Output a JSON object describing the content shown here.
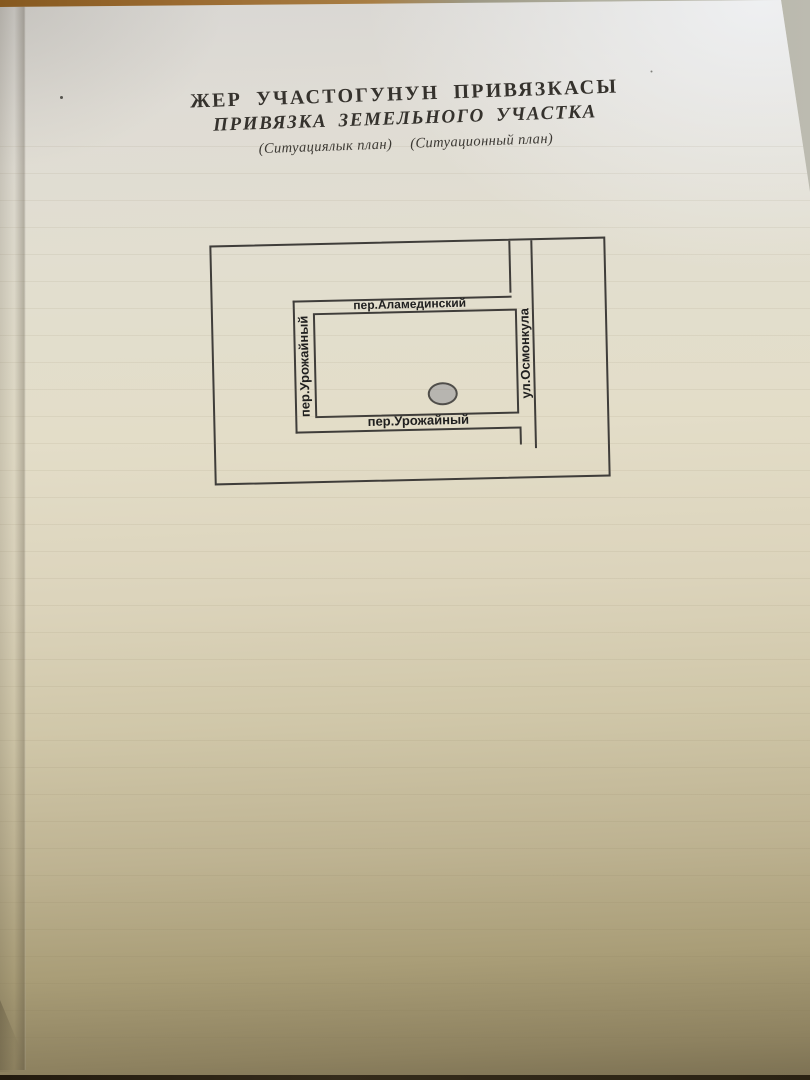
{
  "document": {
    "title_kyrgyz": "ЖЕР  УЧАСТОГУНУН  ПРИВЯЗКАСЫ",
    "title_russian": "ПРИВЯЗКА  ЗЕМЕЛЬНОГО  УЧАСТКА",
    "subtitle_kyrgyz": "(Ситуациялык план)",
    "subtitle_russian": "(Ситуационный план)"
  },
  "site_plan": {
    "streets": {
      "top": "пер.Аламединский",
      "left": "пер.Урожайный",
      "bottom": "пер.Урожайный",
      "right": "ул.Осмонкула"
    },
    "plot_marker": "gray-ellipse"
  },
  "colors": {
    "ink": "#3f3d3a",
    "label_ink": "#1f1f1f",
    "title_ink": "#35322d",
    "marker_fill": "#b7b5b0",
    "marker_stroke": "#504e4a",
    "paper_top": "#d9d7d3",
    "paper_mid": "#e3ddc8",
    "paper_low": "#beb392",
    "paper_bottom": "#7b7052",
    "table_brown": "#9a6a30",
    "table_gray": "#b2b1a2"
  }
}
